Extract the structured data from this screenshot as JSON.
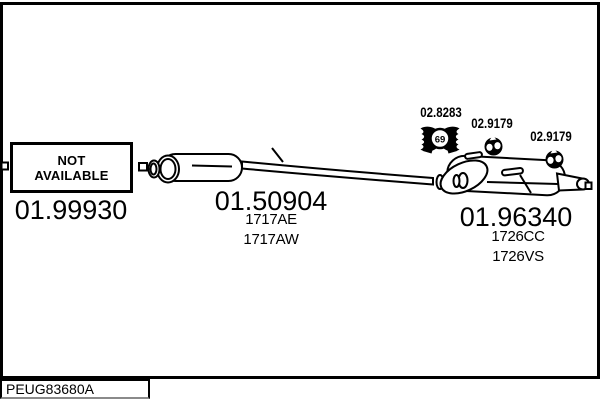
{
  "window": {
    "drawing_code": "PEUG83680A"
  },
  "parts": {
    "front_pipe": {
      "number": "01.99930",
      "availability_line1": "NOT",
      "availability_line2": "AVAILABLE"
    },
    "centre_silencer": {
      "number": "01.50904",
      "oe_refs": [
        "1717AE",
        "1717AW"
      ]
    },
    "rear_silencer": {
      "number": "01.96340",
      "oe_refs": [
        "1726CC",
        "1726VS"
      ]
    },
    "clamp": {
      "number": "02.8283",
      "size": "69"
    },
    "hanger_front": {
      "number": "02.9179"
    },
    "hanger_rear": {
      "number": "02.9179"
    }
  }
}
